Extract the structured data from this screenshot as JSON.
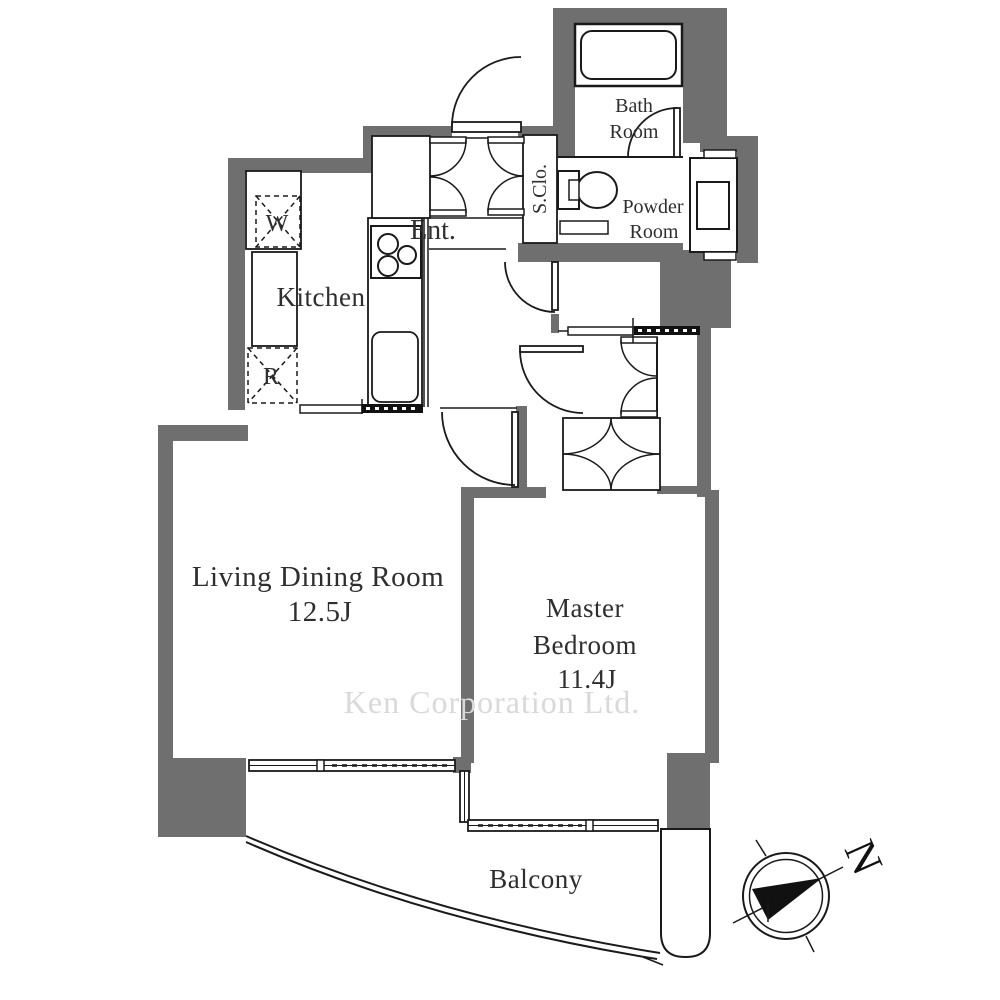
{
  "rooms": {
    "bath": {
      "line1": "Bath",
      "line2": "Room"
    },
    "powder": {
      "line1": "Powder",
      "line2": "Room"
    },
    "shoe_closet": {
      "label": "S.Clo."
    },
    "entrance": {
      "label": "Ent."
    },
    "kitchen": {
      "label": "Kitchen"
    },
    "washer": {
      "label": "W"
    },
    "refrigerator": {
      "label": "R"
    },
    "living_dining": {
      "label": "Living Dining Room",
      "size": "12.5J"
    },
    "master_bedroom": {
      "line1": "Master",
      "line2": "Bedroom",
      "size": "11.4J"
    },
    "balcony": {
      "label": "Balcony"
    }
  },
  "compass": {
    "north": "N"
  },
  "watermark": {
    "text": "Ken Corporation Ltd."
  },
  "colors": {
    "wall": "#6f6f6f",
    "line": "#1a1a1a",
    "text": "#2e2e2e",
    "watermark": "#d9d9d9",
    "background": "#ffffff"
  }
}
